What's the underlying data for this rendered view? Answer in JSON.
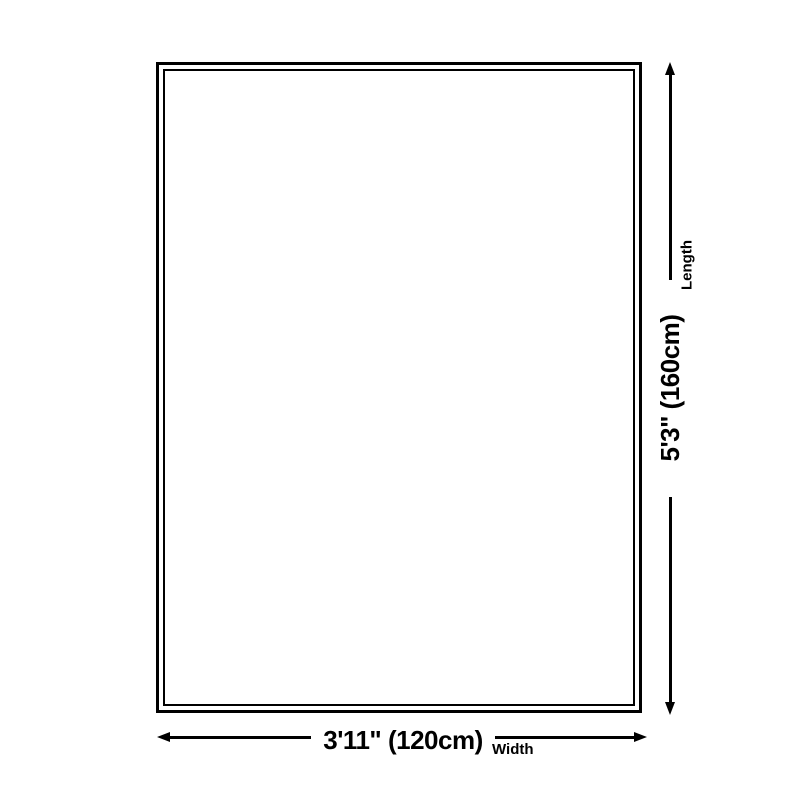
{
  "diagram": {
    "title": "rug-size-diagram",
    "length": {
      "label": "Length",
      "value": "5'3\" (160cm)"
    },
    "width": {
      "label": "Width",
      "value": "3'11\" (120cm)"
    },
    "colors": {
      "line": "#000000",
      "background": "#ffffff"
    }
  }
}
